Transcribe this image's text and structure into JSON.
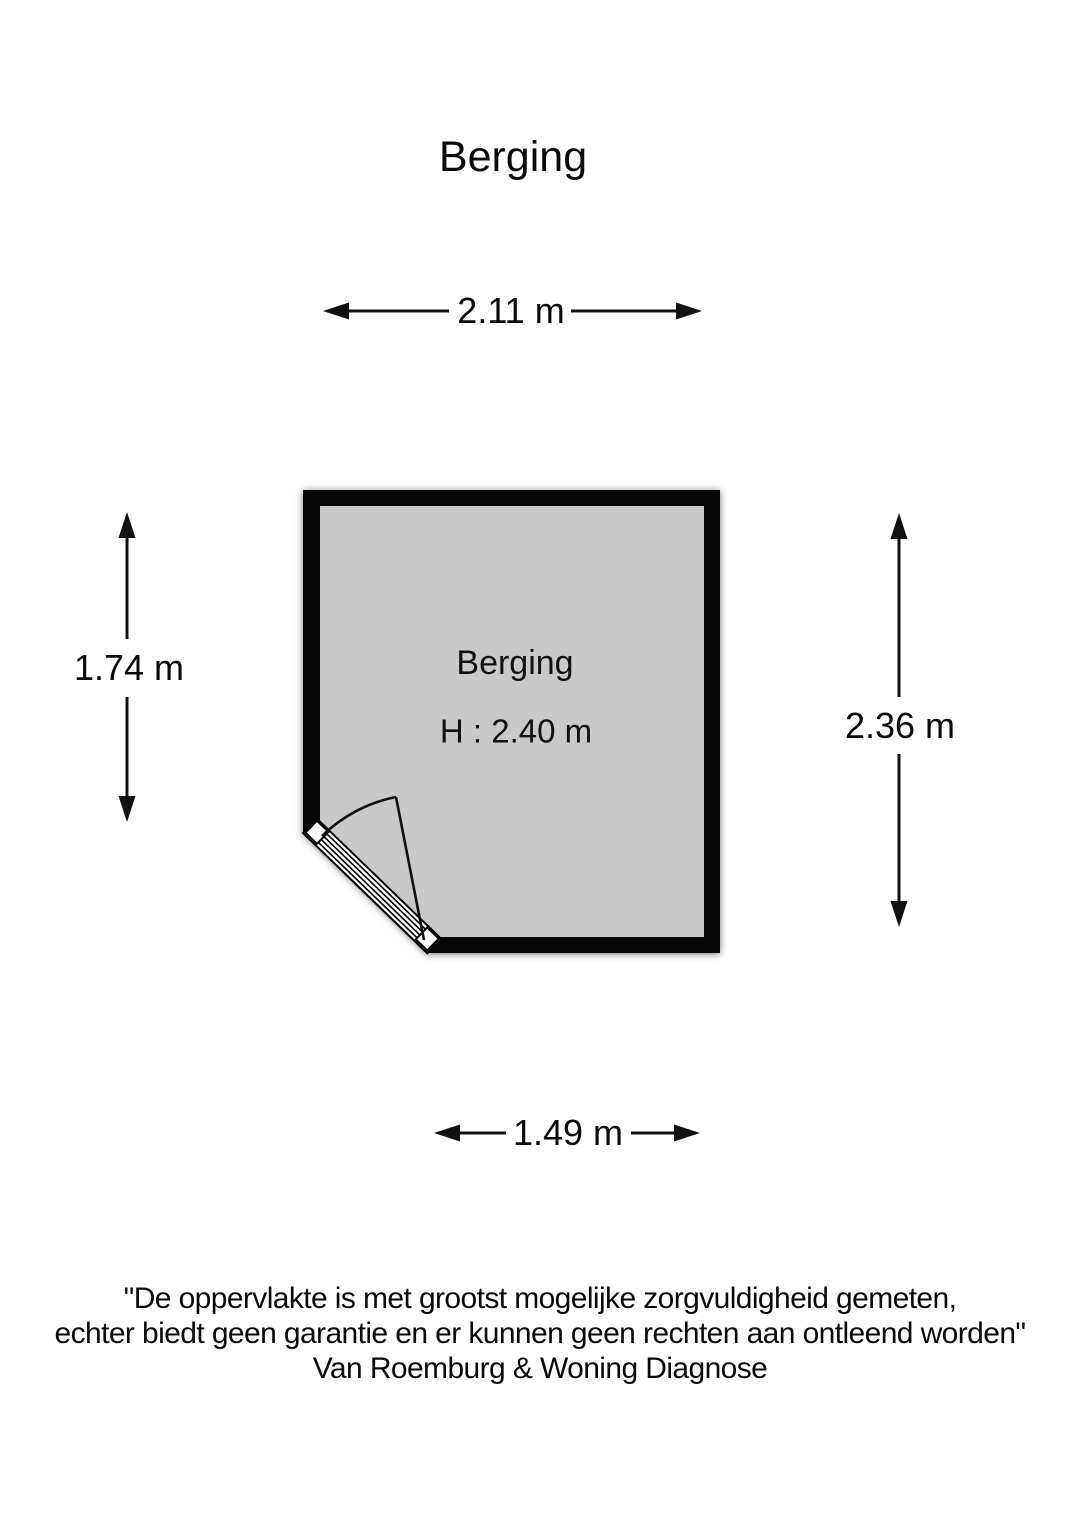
{
  "page": {
    "title": "Berging"
  },
  "floorplan": {
    "room": {
      "name": "Berging",
      "height_label": "H : 2.40 m",
      "wall_color": "#050505",
      "floor_color": "#c9c9c9",
      "door_color": "#ffffff"
    },
    "dimensions": {
      "top": "2.11 m",
      "left": "1.74 m",
      "right": "2.36 m",
      "bottom": "1.49 m"
    }
  },
  "disclaimer": {
    "line1": "\"De oppervlakte is met grootst mogelijke zorgvuldigheid gemeten,",
    "line2": "echter biedt geen garantie en er kunnen geen rechten aan ontleend worden\"",
    "line3": "Van Roemburg & Woning Diagnose"
  }
}
